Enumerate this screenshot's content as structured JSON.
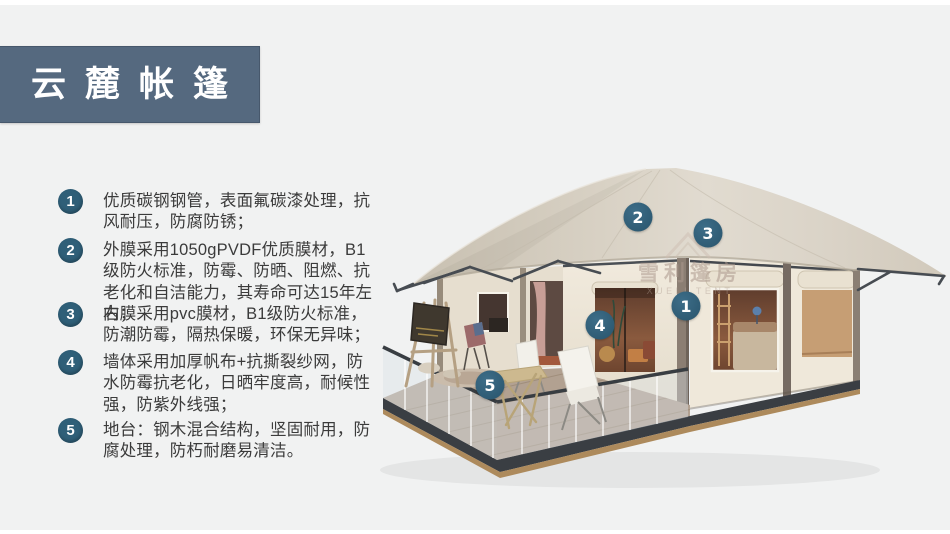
{
  "page": {
    "background_color": "#f1f2f2"
  },
  "header": {
    "title": "云麓帐篷",
    "background_color": "#55697f",
    "text_color": "#ffffff"
  },
  "features": [
    {
      "number": "1",
      "text": "优质碳钢钢管，表面氟碳漆处理，抗风耐压，防腐防锈；"
    },
    {
      "number": "2",
      "text": "外膜采用1050gPVDF优质膜材，B1级防火标准，防霉、防晒、阻燃、抗老化和自洁能力，其寿命可达15年左右；"
    },
    {
      "number": "3",
      "text": "内膜采用pvc膜材，B1级防火标准，防潮防霉，隔热保暖，环保无异味；"
    },
    {
      "number": "4",
      "text": "墙体采用加厚帆布+抗撕裂纱网，防水防霉抗老化，日晒牢度高，耐候性强，防紫外线强；"
    },
    {
      "number": "5",
      "text": "地台：钢木混合结构，坚固耐用，防腐处理，防朽耐磨易清洁。"
    }
  ],
  "diagram": {
    "badge_color": "#2f5f78",
    "callouts": [
      {
        "number": "1"
      },
      {
        "number": "2"
      },
      {
        "number": "3"
      },
      {
        "number": "4"
      },
      {
        "number": "5"
      }
    ],
    "watermark": {
      "line1": "雪利篷房",
      "line2": "XUELI TENT"
    }
  }
}
